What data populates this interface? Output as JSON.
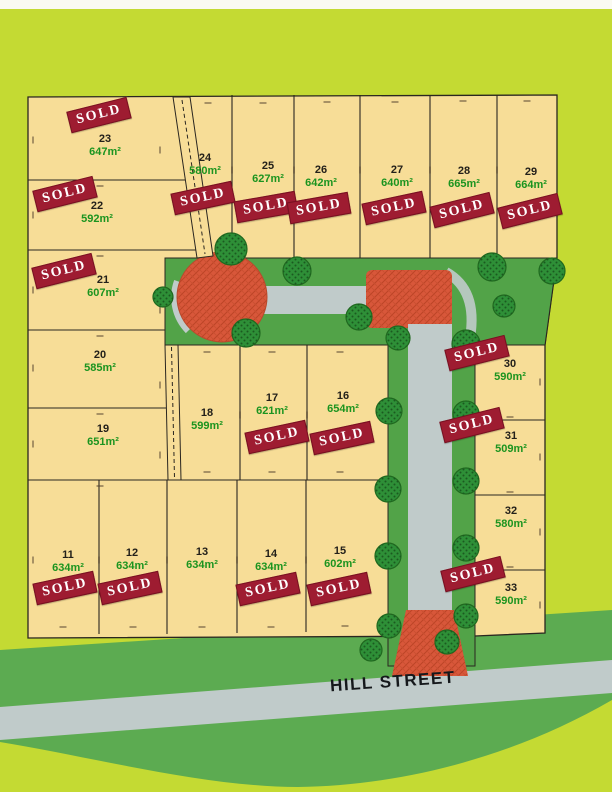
{
  "street": {
    "name": "HILL STREET"
  },
  "stamp_text": "SOLD",
  "colors": {
    "background_lime": "#c4da33",
    "lot_fill": "#f7dd97",
    "verge_green": "#52a348",
    "street_green": "#5cab51",
    "road_gray": "#c0cbca",
    "paving_red": "#d8573a",
    "sold_stamp": "#9e1c31",
    "area_text": "#1b941f"
  },
  "lots": [
    {
      "id": "11",
      "area": "634m²",
      "sold": true,
      "label": {
        "x": 68,
        "y": 555
      },
      "stamp": {
        "x": 66,
        "y": 588,
        "rot": -12
      }
    },
    {
      "id": "12",
      "area": "634m²",
      "sold": true,
      "label": {
        "x": 132,
        "y": 553
      },
      "stamp": {
        "x": 131,
        "y": 588,
        "rot": -12
      }
    },
    {
      "id": "13",
      "area": "634m²",
      "sold": false,
      "label": {
        "x": 202,
        "y": 552
      }
    },
    {
      "id": "14",
      "area": "634m²",
      "sold": true,
      "label": {
        "x": 271,
        "y": 554
      },
      "stamp": {
        "x": 269,
        "y": 589,
        "rot": -12
      }
    },
    {
      "id": "15",
      "area": "602m²",
      "sold": true,
      "label": {
        "x": 340,
        "y": 551
      },
      "stamp": {
        "x": 340,
        "y": 589,
        "rot": -12
      }
    },
    {
      "id": "16",
      "area": "654m²",
      "sold": true,
      "label": {
        "x": 343,
        "y": 396
      },
      "stamp": {
        "x": 343,
        "y": 438,
        "rot": -12
      }
    },
    {
      "id": "17",
      "area": "621m²",
      "sold": true,
      "label": {
        "x": 272,
        "y": 398
      },
      "stamp": {
        "x": 278,
        "y": 437,
        "rot": -12
      }
    },
    {
      "id": "18",
      "area": "599m²",
      "sold": false,
      "label": {
        "x": 207,
        "y": 413
      }
    },
    {
      "id": "19",
      "area": "651m²",
      "sold": false,
      "label": {
        "x": 103,
        "y": 429
      }
    },
    {
      "id": "20",
      "area": "585m²",
      "sold": false,
      "label": {
        "x": 100,
        "y": 355
      }
    },
    {
      "id": "21",
      "area": "607m²",
      "sold": true,
      "label": {
        "x": 103,
        "y": 280
      },
      "stamp": {
        "x": 65,
        "y": 271,
        "rot": -14
      }
    },
    {
      "id": "22",
      "area": "592m²",
      "sold": true,
      "label": {
        "x": 97,
        "y": 206
      },
      "stamp": {
        "x": 66,
        "y": 194,
        "rot": -14
      }
    },
    {
      "id": "23",
      "area": "647m²",
      "sold": true,
      "label": {
        "x": 105,
        "y": 139
      },
      "stamp": {
        "x": 100,
        "y": 115,
        "rot": -14
      }
    },
    {
      "id": "24",
      "area": "580m²",
      "sold": true,
      "label": {
        "x": 205,
        "y": 158
      },
      "stamp": {
        "x": 204,
        "y": 198,
        "rot": -12
      }
    },
    {
      "id": "25",
      "area": "627m²",
      "sold": true,
      "label": {
        "x": 268,
        "y": 166
      },
      "stamp": {
        "x": 267,
        "y": 207,
        "rot": -10
      }
    },
    {
      "id": "26",
      "area": "642m²",
      "sold": true,
      "label": {
        "x": 321,
        "y": 170
      },
      "stamp": {
        "x": 320,
        "y": 208,
        "rot": -10
      }
    },
    {
      "id": "27",
      "area": "640m²",
      "sold": true,
      "label": {
        "x": 397,
        "y": 170
      },
      "stamp": {
        "x": 395,
        "y": 208,
        "rot": -12
      }
    },
    {
      "id": "28",
      "area": "665m²",
      "sold": true,
      "label": {
        "x": 464,
        "y": 171
      },
      "stamp": {
        "x": 463,
        "y": 210,
        "rot": -14
      }
    },
    {
      "id": "29",
      "area": "664m²",
      "sold": true,
      "label": {
        "x": 531,
        "y": 172
      },
      "stamp": {
        "x": 531,
        "y": 211,
        "rot": -14
      }
    },
    {
      "id": "30",
      "area": "590m²",
      "sold": true,
      "label": {
        "x": 510,
        "y": 364
      },
      "stamp": {
        "x": 478,
        "y": 353,
        "rot": -14
      }
    },
    {
      "id": "31",
      "area": "509m²",
      "sold": true,
      "label": {
        "x": 511,
        "y": 436
      },
      "stamp": {
        "x": 473,
        "y": 425,
        "rot": -14
      }
    },
    {
      "id": "32",
      "area": "580m²",
      "sold": false,
      "label": {
        "x": 511,
        "y": 511
      }
    },
    {
      "id": "33",
      "area": "590m²",
      "sold": true,
      "label": {
        "x": 511,
        "y": 588
      },
      "stamp": {
        "x": 474,
        "y": 574,
        "rot": -14
      }
    }
  ]
}
